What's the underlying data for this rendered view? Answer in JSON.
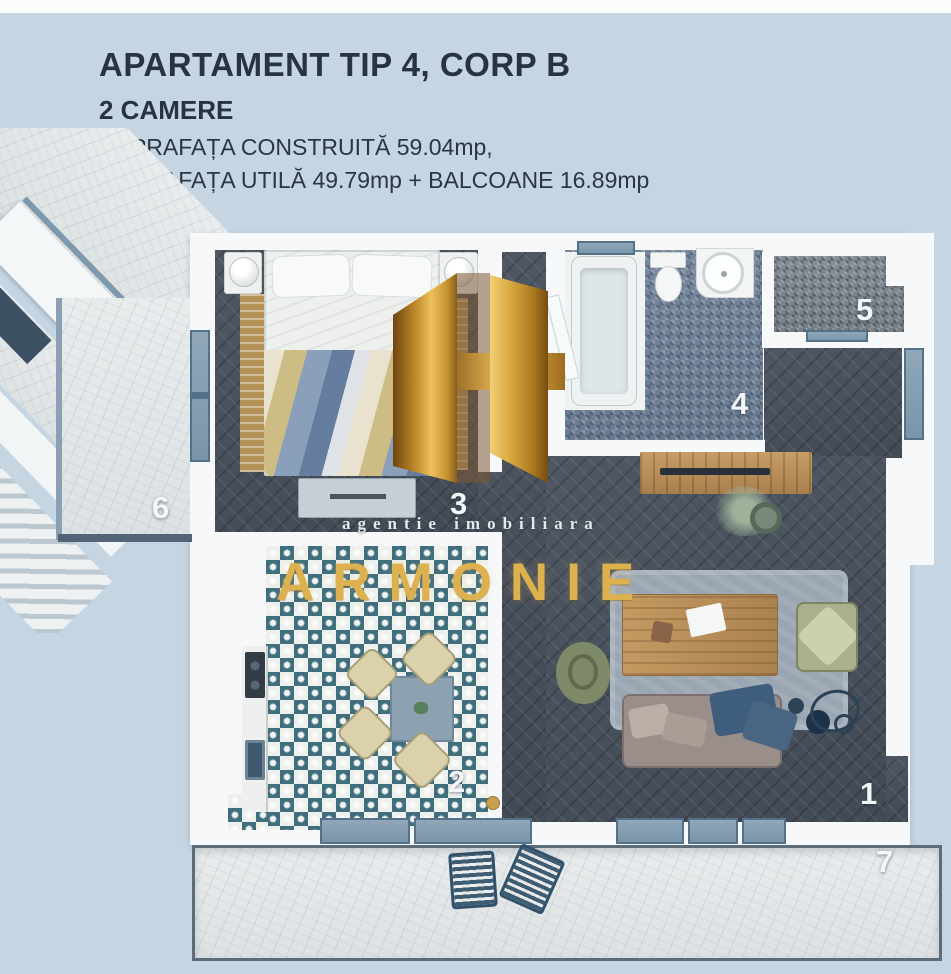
{
  "header": {
    "title": "APARTAMENT TIP 4, CORP B",
    "subtitle": "2 CAMERE",
    "area_built": "SUPRAFAȚA CONSTRUITĂ 59.04mp,",
    "area_usable": "SUPRAFAȚA UTILĂ 49.79mp + BALCOANE 16.89mp"
  },
  "watermark": {
    "logo_icon": "gold-h-monogram",
    "tagline": "agentie imobiliara",
    "brand": "ARMONIE"
  },
  "room_labels": {
    "living": "1",
    "kitchen": "2",
    "bedroom": "3",
    "bathroom": "4",
    "balcony_top": "5",
    "balcony_left": "6",
    "terrace": "7"
  },
  "colors": {
    "page_background": "#c5d5e2",
    "heading_text": "#28333f",
    "brand_gold": "#ddb14e",
    "dark_floor": "#4a525d",
    "bath_tile": "#73859a",
    "kitchen_tile_accent": "#3f6e7d",
    "window_frame": "#7e99ad",
    "light_floor": "#e2e7e8"
  }
}
